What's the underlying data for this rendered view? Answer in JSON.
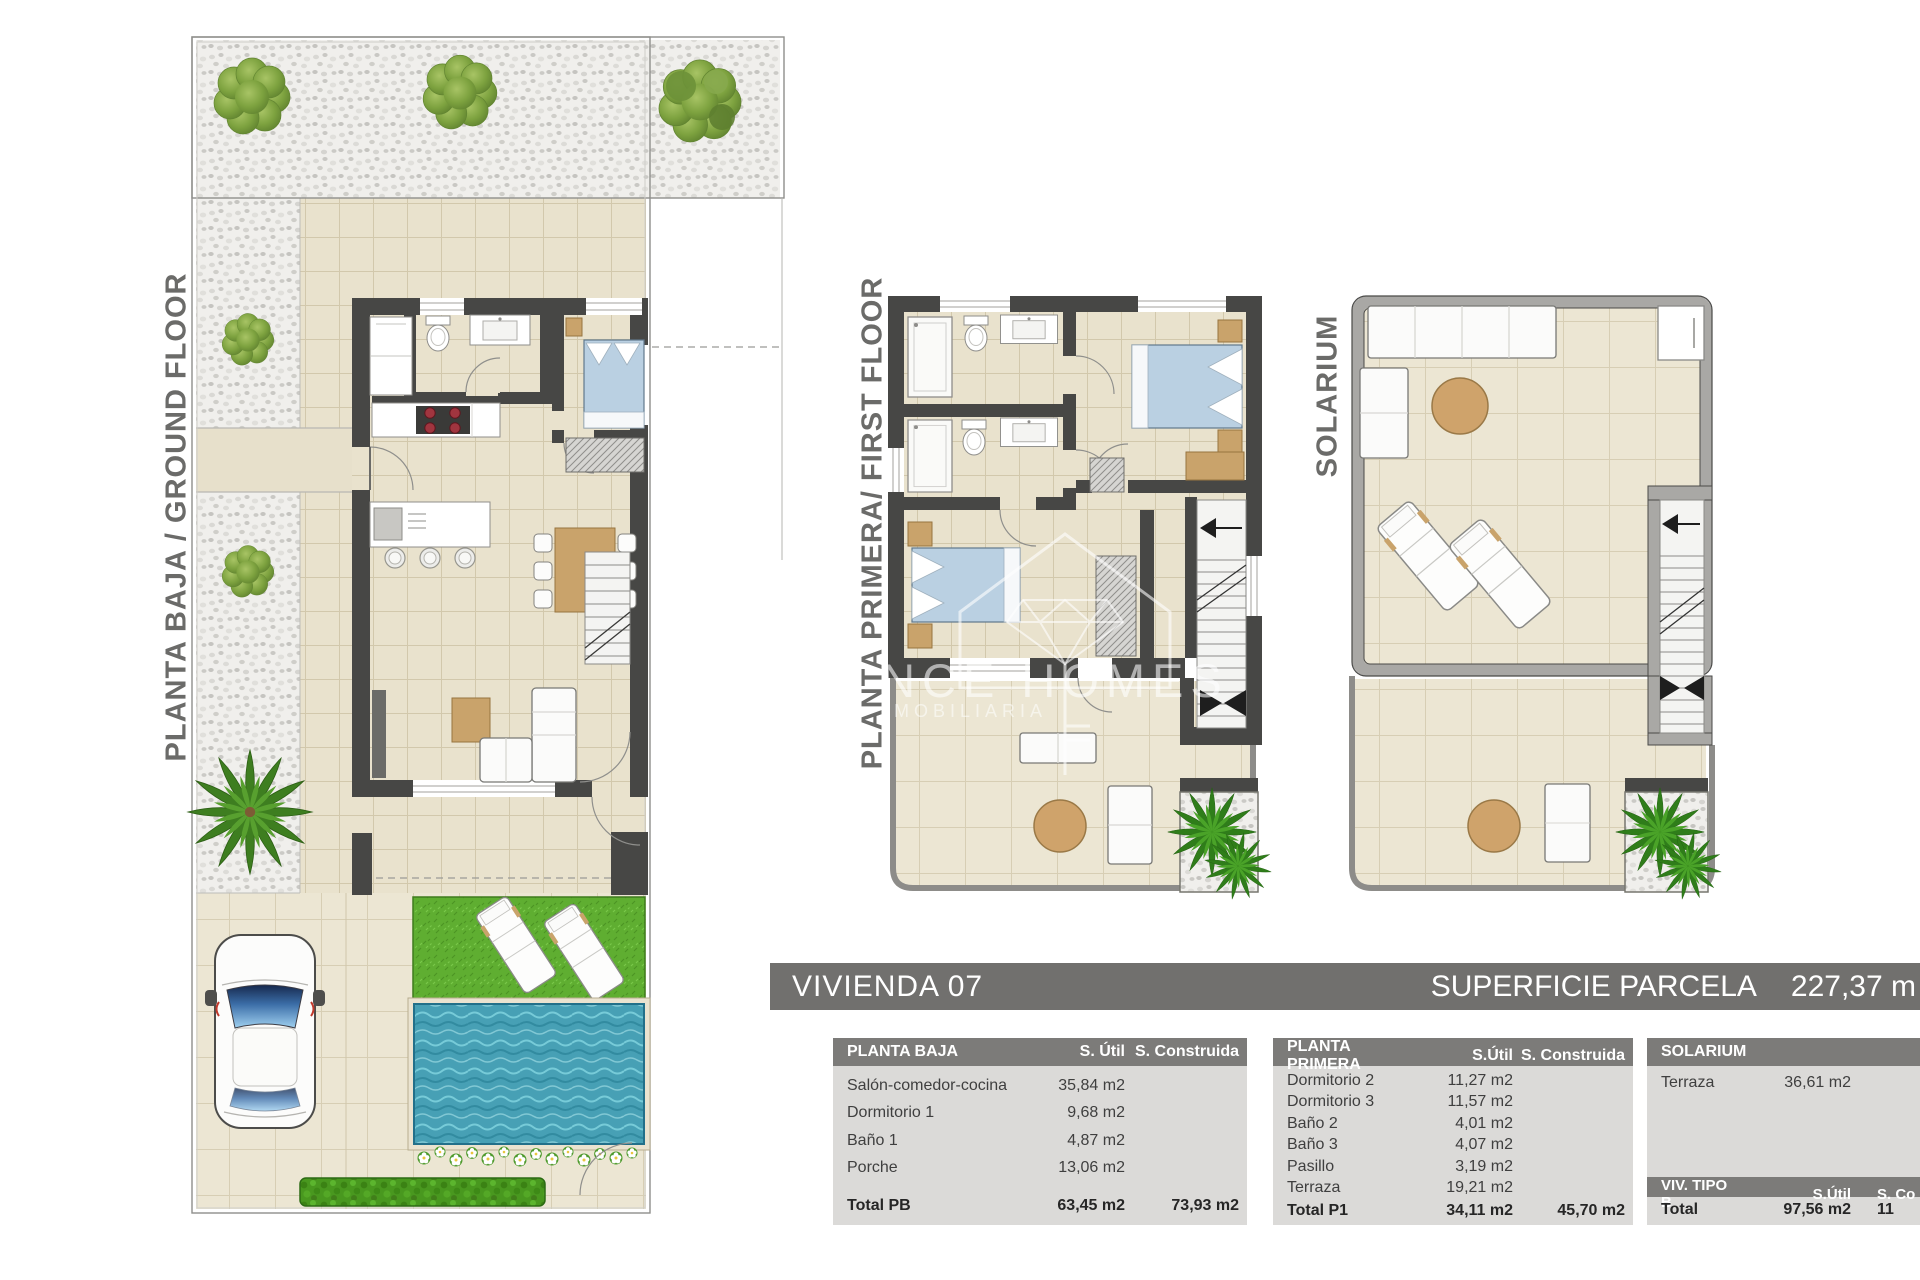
{
  "header": {
    "unit_title": "VIVIENDA 07",
    "parcel_label": "SUPERFICIE PARCELA",
    "parcel_value": "227,37 m"
  },
  "plan_labels": {
    "ground": "PLANTA BAJA / GROUND FLOOR",
    "first": "PLANTA PRIMERA/ FIRST FLOOR",
    "solarium": "SOLARIUM"
  },
  "watermark": {
    "brand": "BLANCE HOMES",
    "subtitle": "INMOBILIARIA"
  },
  "tables": [
    {
      "title": "PLANTA BAJA",
      "col1": "S. Útil",
      "col2": "S. Construida",
      "rows": [
        [
          "Salón-comedor-cocina",
          "35,84 m2"
        ],
        [
          "Dormitorio 1",
          "9,68 m2"
        ],
        [
          "Baño 1",
          "4,87 m2"
        ],
        [
          "Porche",
          "13,06 m2"
        ]
      ],
      "total": [
        "Total PB",
        "63,45 m2",
        "73,93 m2"
      ]
    },
    {
      "title": "PLANTA PRIMERA",
      "col1": "S.Útil",
      "col2": "S. Construida",
      "rows": [
        [
          "Dormitorio 2",
          "11,27 m2"
        ],
        [
          "Dormitorio 3",
          "11,57 m2"
        ],
        [
          "Baño 2",
          "4,01 m2"
        ],
        [
          "Baño 3",
          "4,07 m2"
        ],
        [
          "Pasillo",
          "3,19 m2"
        ],
        [
          "Terraza",
          "19,21 m2"
        ]
      ],
      "total": [
        "Total P1",
        "34,11 m2",
        "45,70 m2"
      ]
    },
    {
      "title": "SOLARIUM",
      "rows": [
        [
          "Terraza",
          "36,61 m2"
        ]
      ],
      "footer": [
        "VIV. TIPO B",
        "S.Útil",
        "S. Co"
      ],
      "total": [
        "Total",
        "97,56 m2",
        "11"
      ]
    }
  ],
  "colors": {
    "wall_dark": "#474745",
    "solarium_wall": "#a9a8a5",
    "floor_tile": "#e9e2cd",
    "gravel": "#f0efec",
    "grass_green": "#5fae31",
    "pool_water": "#47a0b5",
    "bed_blue": "#bad0e2",
    "wood_tan": "#c9a36b",
    "hedge_green": "#49981f",
    "title_bar_bg": "#71706e",
    "table_header_bg": "#7c7b79",
    "table_body_bg": "#dbdad8"
  }
}
